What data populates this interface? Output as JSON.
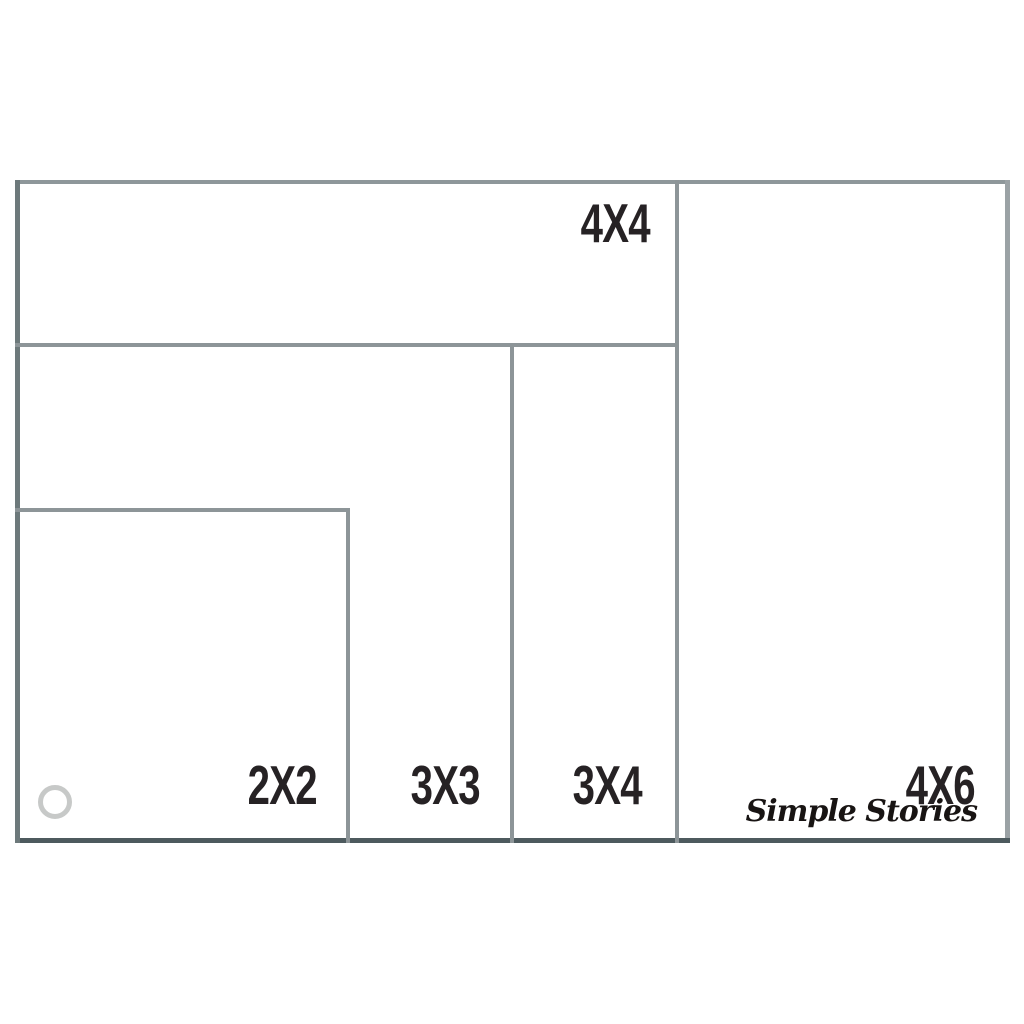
{
  "diagram": {
    "type": "nested-size-comparison",
    "sizes": [
      {
        "label": "2X2"
      },
      {
        "label": "3X3"
      },
      {
        "label": "3X4"
      },
      {
        "label": "4X4"
      },
      {
        "label": "4X6"
      }
    ],
    "brand": {
      "name": "Simple Stories"
    },
    "colors": {
      "background": "#ffffff",
      "line": "#8d9598",
      "line_left": "#6d797b",
      "line_bottom": "#4d5a5e",
      "label_text": "#262224",
      "binder_hole_ring": "#c7c9c8",
      "brand_text": "#181413"
    }
  }
}
